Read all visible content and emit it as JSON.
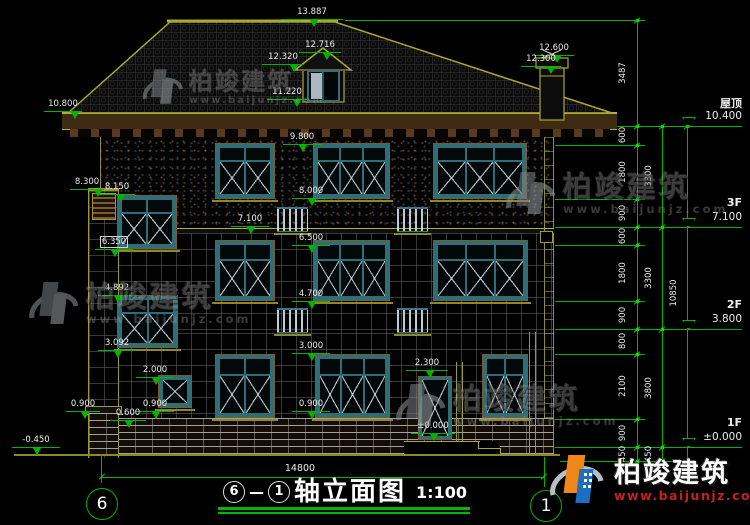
{
  "drawing": {
    "title": {
      "axis_start": "6",
      "separator": "—",
      "axis_end": "1",
      "name": "轴立面图",
      "scale": "1:100"
    },
    "bottom_dim": "14800",
    "axis_bubbles": [
      "6",
      "1"
    ]
  },
  "levels": [
    {
      "name": "屋顶",
      "value": "10.400",
      "y": 126
    },
    {
      "name": "3F",
      "value": "7.100",
      "y": 227
    },
    {
      "name": "2F",
      "value": "3.800",
      "y": 329
    },
    {
      "name": "1F",
      "value": "±0.000",
      "y": 447
    }
  ],
  "right_dimensions": {
    "chain1": [
      {
        "text": "3487",
        "y": 73
      },
      {
        "text": "600",
        "y": 135
      },
      {
        "text": "1800",
        "y": 172
      },
      {
        "text": "900",
        "y": 213
      },
      {
        "text": "600",
        "y": 236
      },
      {
        "text": "1800",
        "y": 273
      },
      {
        "text": "900",
        "y": 315
      },
      {
        "text": "800",
        "y": 341
      },
      {
        "text": "2100",
        "y": 386
      },
      {
        "text": "900",
        "y": 433
      },
      {
        "text": "450",
        "y": 454
      }
    ],
    "chain2": [
      {
        "text": "3300",
        "y": 176
      },
      {
        "text": "3300",
        "y": 278
      },
      {
        "text": "3800",
        "y": 388
      },
      {
        "text": "450",
        "y": 454
      }
    ],
    "chain3": [
      {
        "text": "10850",
        "y": 293
      }
    ]
  },
  "elevation_marks": [
    {
      "v": "13.887",
      "x": 281,
      "y": 19,
      "w": 62,
      "t": 55
    },
    {
      "v": "12.716",
      "x": 299,
      "y": 52,
      "w": 42,
      "t": 70
    },
    {
      "v": "12.320",
      "x": 262,
      "y": 64,
      "w": 42,
      "t": 78
    },
    {
      "v": "11.220",
      "x": 267,
      "y": 99,
      "w": 40,
      "t": 78
    },
    {
      "v": "12.600",
      "x": 534,
      "y": 55,
      "w": 40,
      "t": 60
    },
    {
      "v": "12.300",
      "x": 521,
      "y": 66,
      "w": 40,
      "t": 78
    },
    {
      "v": "10.800",
      "x": 44,
      "y": 111,
      "w": 38,
      "t": 85
    },
    {
      "v": "9.800",
      "x": 283,
      "y": 144,
      "w": 38,
      "t": 55
    },
    {
      "v": "8.300",
      "x": 70,
      "y": 189,
      "w": 34,
      "t": 85
    },
    {
      "v": "8.150",
      "x": 99,
      "y": 194,
      "w": 36,
      "t": 65
    },
    {
      "v": "8.000",
      "x": 292,
      "y": 198,
      "w": 38,
      "t": 55
    },
    {
      "v": "7.100",
      "x": 231,
      "y": 226,
      "w": 38,
      "t": 55
    },
    {
      "v": "6.500",
      "x": 292,
      "y": 245,
      "w": 38,
      "t": 55
    },
    {
      "v": "6.350",
      "x": 95,
      "y": 249,
      "w": 38,
      "t": 55,
      "boxed": true
    },
    {
      "v": "4.892",
      "x": 98,
      "y": 295,
      "w": 38,
      "t": 55
    },
    {
      "v": "4.700",
      "x": 292,
      "y": 301,
      "w": 38,
      "t": 55
    },
    {
      "v": "3.092",
      "x": 98,
      "y": 350,
      "w": 38,
      "t": 55
    },
    {
      "v": "3.000",
      "x": 292,
      "y": 353,
      "w": 38,
      "t": 55
    },
    {
      "v": "2.300",
      "x": 406,
      "y": 370,
      "w": 42,
      "t": 60
    },
    {
      "v": "2.000",
      "x": 136,
      "y": 377,
      "w": 38,
      "t": 55
    },
    {
      "v": "0.900",
      "x": 66,
      "y": 411,
      "w": 34,
      "t": 60
    },
    {
      "v": "0.900",
      "x": 136,
      "y": 411,
      "w": 38,
      "t": 55
    },
    {
      "v": "0.900",
      "x": 292,
      "y": 411,
      "w": 38,
      "t": 55
    },
    {
      "v": "0.600",
      "x": 110,
      "y": 420,
      "w": 36,
      "t": 55
    },
    {
      "v": "±0.000",
      "x": 411,
      "y": 433,
      "w": 44,
      "t": 55
    },
    {
      "v": "-0.450",
      "x": 12,
      "y": 447,
      "w": 48,
      "t": 55
    }
  ],
  "watermark": {
    "brand": "柏竣建筑",
    "url": "www.baijunjz.com"
  },
  "logo": {
    "brand": "柏竣建筑",
    "url": "www.baijunjz.com"
  },
  "colors": {
    "dim_green": "#00b400",
    "outline_yellow": "#a8a832",
    "frame_teal": "#2e6e74",
    "logo_orange": "#f08519",
    "logo_blue": "#1c6fc0",
    "url_red": "#c22222"
  }
}
